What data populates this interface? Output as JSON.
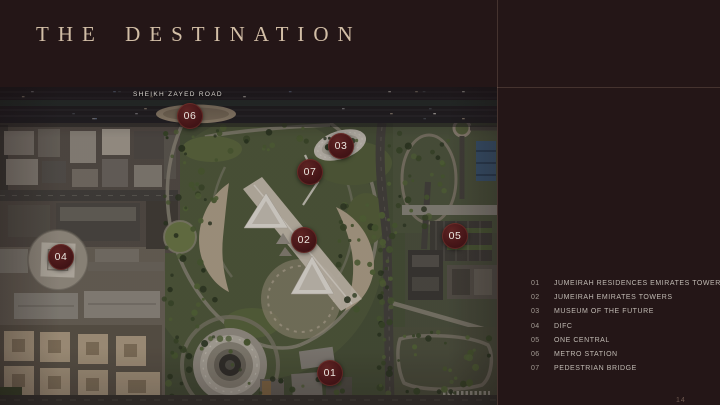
{
  "title": "THE DESTINATION",
  "map": {
    "road_label": "SHEIKH ZAYED ROAD",
    "markers": [
      {
        "num": "01",
        "x": 330,
        "y": 286
      },
      {
        "num": "02",
        "x": 304,
        "y": 153
      },
      {
        "num": "03",
        "x": 341,
        "y": 59
      },
      {
        "num": "04",
        "x": 61,
        "y": 170
      },
      {
        "num": "05",
        "x": 455,
        "y": 149
      },
      {
        "num": "06",
        "x": 190,
        "y": 29
      },
      {
        "num": "07",
        "x": 310,
        "y": 85
      }
    ]
  },
  "legend": {
    "items": [
      {
        "num": "01",
        "label": "JUMEIRAH RESIDENCES EMIRATES TOWERS"
      },
      {
        "num": "02",
        "label": "JUMEIRAH EMIRATES TOWERS"
      },
      {
        "num": "03",
        "label": "MUSEUM OF THE FUTURE"
      },
      {
        "num": "04",
        "label": "DIFC"
      },
      {
        "num": "05",
        "label": "ONE CENTRAL"
      },
      {
        "num": "06",
        "label": "METRO STATION"
      },
      {
        "num": "07",
        "label": "PEDESTRIAN BRIDGE"
      }
    ]
  },
  "page_number": "14",
  "colors": {
    "background": "#241617",
    "title_text": "#d2bea6",
    "legend_text": "#c0bab3",
    "marker_fill": "#471618",
    "marker_text": "#ece6df",
    "frame_line": "#8a6f5f"
  }
}
